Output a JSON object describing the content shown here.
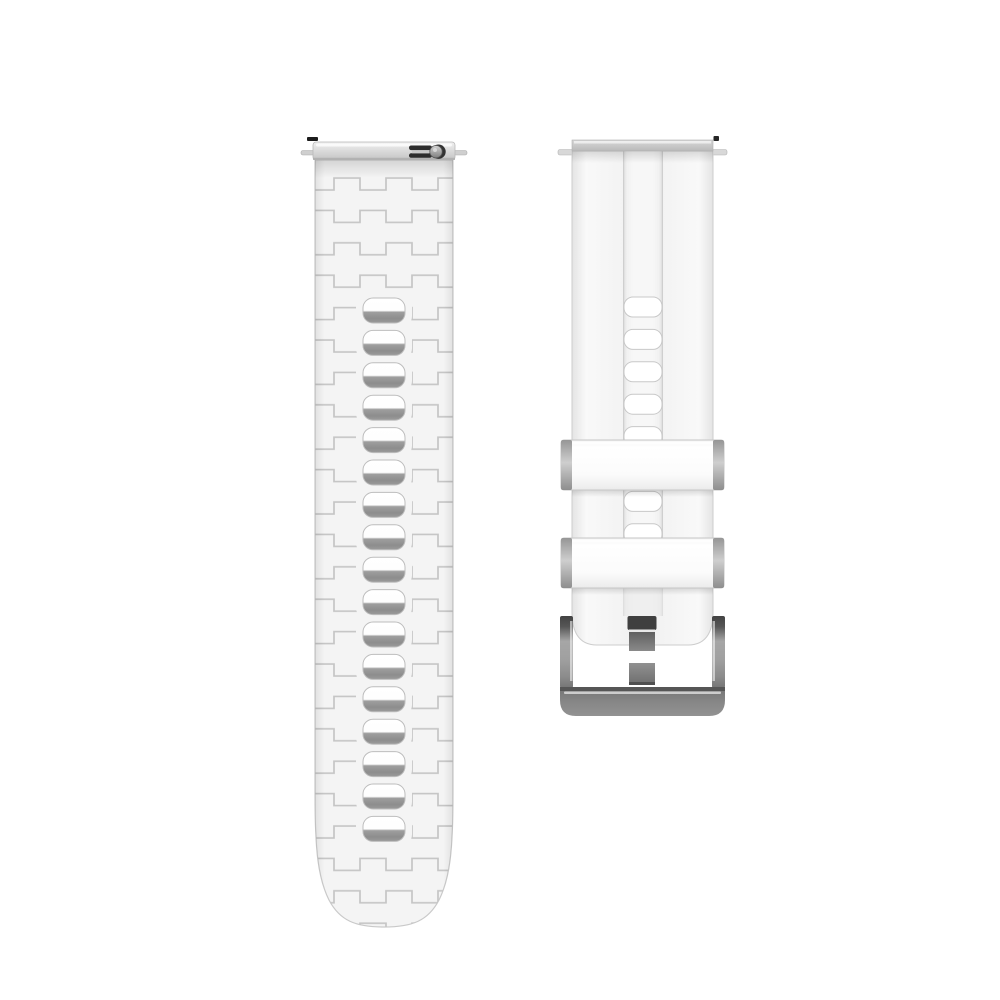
{
  "scene": {
    "description": "White silicone quick-release watch band, two pieces on white background",
    "left_piece": "tail strap with embossed weave texture and adjustment holes",
    "right_piece": "buckle strap with two keeper loops and metal clasp"
  },
  "colors": {
    "background": "#ffffff",
    "strap_base": "#f4f4f4",
    "strap_edge": "#c9c9c9",
    "texture_line": "#c5c5c5",
    "hole_shadow": "#8f8f8f",
    "lug_bar_light": "#eeeeee",
    "lug_bar_dark": "#c4c4c4",
    "keeper_cap": "#9a9a9a",
    "buckle_metal": "#8e8e8e",
    "buckle_dark": "#424242",
    "prong": "#757575",
    "release_tab": "#2d2d2d",
    "pin": "#cfcfcf"
  },
  "left_strap": {
    "x": 315,
    "width": 138,
    "body_top": 160,
    "body_bottom": 927,
    "taper_start": 795,
    "bar": {
      "x": 313,
      "y": 142,
      "width": 142,
      "height": 18
    },
    "holes": {
      "count": 17,
      "first_y": 298,
      "pitch": 32.4,
      "x": 363,
      "width": 42,
      "height": 25,
      "rx": 10
    },
    "clearing": {
      "pad_x": 7,
      "pad_y": 5,
      "rx": 12
    },
    "texture": {
      "period": 52,
      "row_pitch": 32.4,
      "amplitude": 12
    },
    "quick_release_tab": true
  },
  "right_strap": {
    "x": 572,
    "width": 141,
    "body_top": 151,
    "body_bottom": 645,
    "bar": {
      "x": 572,
      "y": 140,
      "width": 141,
      "height": 11
    },
    "channel": {
      "x": 623,
      "width": 40,
      "top": 151,
      "bottom": 616
    },
    "holes": {
      "count": 8,
      "first_y": 297,
      "pitch": 32.4,
      "x": 624,
      "width": 38,
      "height": 20,
      "rx": 9
    },
    "keepers": [
      {
        "y": 440,
        "height": 50
      },
      {
        "y": 538,
        "height": 50
      }
    ],
    "keeper_span": {
      "x": 561,
      "width": 163,
      "cap_width": 11
    },
    "buckle": {
      "frame_top": 616,
      "frame_height": 72,
      "left_bar_x": 560,
      "right_bar_x": 712,
      "bar_width": 13,
      "bottom_bar": {
        "x": 560,
        "y": 687,
        "width": 165,
        "height": 29
      },
      "prong": {
        "x": 629,
        "width": 26,
        "cap_y": 616,
        "cap_h": 14,
        "seg1_y": 632,
        "seg1_h": 19,
        "seg2_y": 663,
        "seg2_h": 22
      }
    }
  }
}
